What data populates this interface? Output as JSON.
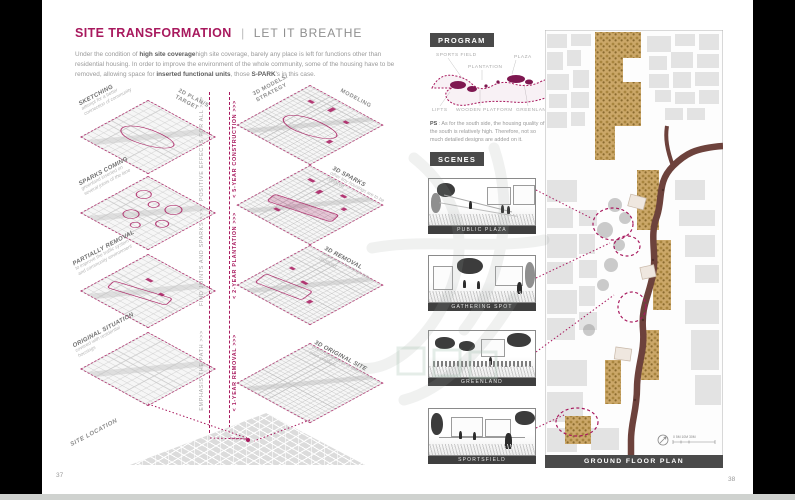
{
  "page": {
    "left_number": "37",
    "right_number": "38"
  },
  "left_page": {
    "title": "SITE TRANSFORMATION",
    "divider": "|",
    "subtitle": "LET IT BREATHE",
    "intro": [
      "Under the condition of ",
      "high site coverage",
      "high site coverage, barely any place is left for functions other than residential housing. In order to improve the environment of the whole community, some of the housing have to be removed, allowing space for ",
      "inserted functional units",
      ", those ",
      "S-PARK",
      "'s in this case."
    ],
    "columns": {
      "left_header_line1": "2D PLAN/S",
      "left_header_line2": "TARGET",
      "right_header_line1": "3D MODELS/",
      "right_header_line2": "STRATEGY",
      "right_top": "MODELING"
    },
    "tiles_left": [
      {
        "label": "SKETCHING",
        "note": "attempt for a better connection of community"
      },
      {
        "label": "SPARKS COMING",
        "note": "greenland inserted on several joints of the lane"
      },
      {
        "label": "PARTIALLY REMOVAL",
        "note": "to improve the traffic system and community environment"
      },
      {
        "label": "ORIGINAL SITUATION",
        "note": "covered with residential housings"
      }
    ],
    "tiles_right": [
      {
        "label": "3D SPARKS",
        "note": "other tiny housings are to be replaced"
      },
      {
        "label": "3D REMOVAL",
        "note": "some worn housings are removed"
      },
      {
        "label": "3D ORIGINAL SITE",
        "note": "overcrowdedness is the main problem"
      }
    ],
    "timeline_gray": [
      "POSITIVE EFFECTS FOR ALL >>>",
      "FIND JOINTS AND SPARKS >>>",
      "EMPHASIS THE PATH >>>"
    ],
    "timeline_magenta": [
      "< 5-YEAR CONSTRUCTION >>>",
      "< 2-YEAR PLANTATION >>>",
      "< 1-YEAR REMOVAL >>>"
    ],
    "site_location": "SITE LOCATION"
  },
  "right_page": {
    "program": {
      "header": "PROGRAM",
      "labels": [
        "SPORTS FIELD",
        "PLAZA",
        "PLANTATION",
        "LIFTS",
        "WOODEN PLATFORM",
        "GREENLAND"
      ],
      "ps_label": "PS",
      "ps_text": " : As for the south side, the housing quality of the south is relatively high. Therefore, not so much detailed designs are added on it."
    },
    "scenes": {
      "header": "SCENES",
      "items": [
        "PUBLIC PLAZA",
        "GATHERING SPOT",
        "GREENLAND",
        "SPORTSFIELD"
      ]
    },
    "plan": {
      "caption": "GROUND FLOOR PLAN",
      "scale": "0 5M 10M      30M"
    }
  },
  "colors": {
    "accent": "#a8195e",
    "header_bar": "#4a4a4a",
    "road_brown": "#6d423c",
    "foliage_tan": "#c8a463"
  }
}
